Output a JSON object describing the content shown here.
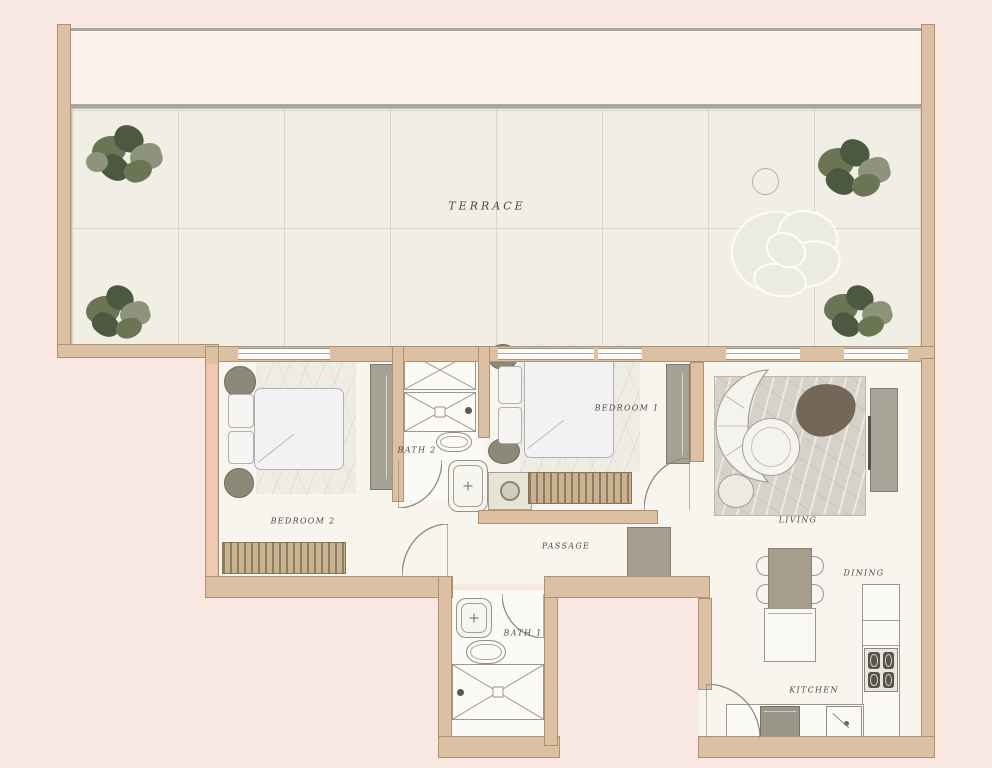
{
  "rooms": {
    "terrace": {
      "label": "TERRACE"
    },
    "bedroom1": {
      "label": "BEDROOM 1"
    },
    "bedroom2": {
      "label": "BEDROOM 2"
    },
    "bath1": {
      "label": "BATH 1"
    },
    "bath2": {
      "label": "BATH 2"
    },
    "passage": {
      "label": "PASSAGE"
    },
    "living": {
      "label": "LIVING"
    },
    "dining": {
      "label": "DINING"
    },
    "kitchen": {
      "label": "KITCHEN"
    }
  },
  "colors": {
    "background": "#f8e8e1",
    "wall": "#dcc0a4",
    "wall_border": "#b2906e",
    "wall_accent": "#f0cab5",
    "band": "#fdf2ed",
    "band_line": "#a9a7a2",
    "terrace_floor": "#f1efe5",
    "tile_line": "#dbd7c6",
    "floor": "#f8f5ee",
    "rug_light": "#efece4",
    "rug_gray": "#d6d2c9",
    "furniture_white": "#f4f3ef",
    "furniture_border": "#a39f95",
    "furniture_gray": "#a8a498",
    "furniture_dark": "#756757",
    "stool_dark": "#8d8979",
    "wood_hatch": "#c7b292",
    "plant_dark": "#4d5840",
    "plant_mid": "#6b7553",
    "plant_light": "#8d947b",
    "line": "#8d8a83",
    "label_text": "#4b4a45"
  }
}
